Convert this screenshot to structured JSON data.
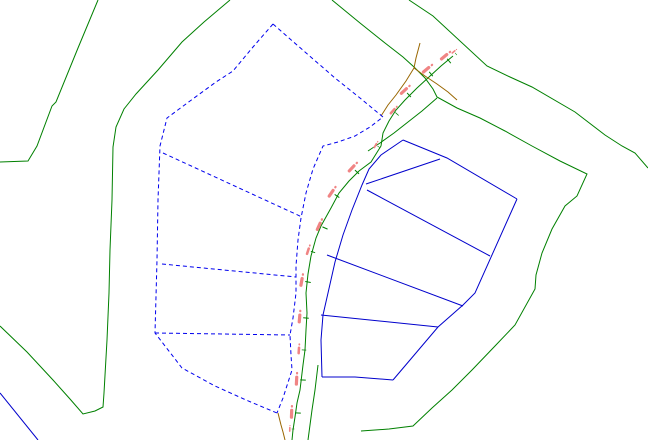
{
  "map": {
    "width": 648,
    "height": 440,
    "background": "#ffffff",
    "colors": {
      "boundary_green": "#008000",
      "alignment_brown": "#996600",
      "parcel_dashed_blue": "#0000ee",
      "parcel_solid_blue": "#0000cc",
      "station_label_red": "#f08484",
      "station_tick_green": "#008000"
    },
    "dash_pattern": "4,3",
    "layers": {
      "boundaries_green": [
        {
          "name": "outer-boundary-left-upper",
          "points": [
            [
              98,
              0
            ],
            [
              78,
              48
            ],
            [
              56,
              102
            ],
            [
              52,
              106
            ],
            [
              37,
              146
            ],
            [
              28,
              161
            ],
            [
              0,
              162
            ]
          ]
        },
        {
          "name": "outer-boundary-left-lower",
          "points": [
            [
              230,
              0
            ],
            [
              204,
              22
            ],
            [
              182,
              42
            ],
            [
              158,
              70
            ],
            [
              136,
              94
            ],
            [
              124,
              109
            ],
            [
              116,
              127
            ],
            [
              113,
              147
            ],
            [
              112,
              200
            ],
            [
              110,
              250
            ],
            [
              109,
              293
            ],
            [
              107,
              340
            ],
            [
              104,
              393
            ],
            [
              103,
              407
            ],
            [
              95,
              411
            ],
            [
              83,
              414
            ],
            [
              70,
              399
            ],
            [
              53,
              380
            ],
            [
              27,
              352
            ],
            [
              0,
              326
            ]
          ]
        },
        {
          "name": "outer-boundary-top-right",
          "points": [
            [
              409,
              0
            ],
            [
              433,
              16
            ],
            [
              487,
              66
            ],
            [
              510,
              77
            ],
            [
              532,
              87
            ],
            [
              575,
              112
            ],
            [
              605,
              135
            ],
            [
              622,
              146
            ],
            [
              635,
              153
            ],
            [
              648,
              168
            ]
          ]
        },
        {
          "name": "inner-boundary-right",
          "points": [
            [
              332,
              0
            ],
            [
              360,
              23
            ],
            [
              385,
              43
            ],
            [
              403,
              57
            ],
            [
              414,
              67
            ],
            [
              425,
              78
            ],
            [
              433,
              89
            ],
            [
              437,
              97
            ],
            [
              457,
              108
            ],
            [
              480,
              118
            ],
            [
              505,
              131
            ],
            [
              532,
              146
            ],
            [
              560,
              161
            ],
            [
              587,
              174
            ],
            [
              577,
              196
            ],
            [
              565,
              206
            ],
            [
              552,
              229
            ],
            [
              542,
              253
            ],
            [
              536,
              275
            ],
            [
              535,
              289
            ],
            [
              515,
              325
            ],
            [
              495,
              346
            ],
            [
              472,
              370
            ],
            [
              452,
              390
            ],
            [
              432,
              408
            ],
            [
              413,
              426
            ],
            [
              389,
              429
            ],
            [
              361,
              431
            ]
          ]
        },
        {
          "name": "road-right-edge-upper",
          "points": [
            [
              437,
              98
            ],
            [
              422,
              111
            ],
            [
              408,
              122
            ],
            [
              394,
              133
            ],
            [
              380,
              143
            ],
            [
              368,
              151
            ]
          ]
        },
        {
          "name": "road-right-edge-lower",
          "points": [
            [
              318,
              365
            ],
            [
              315,
              390
            ],
            [
              312,
              410
            ],
            [
              310,
              425
            ],
            [
              308,
              440
            ]
          ]
        },
        {
          "name": "road-centerline",
          "points": [
            [
              453,
              56
            ],
            [
              441,
              66
            ],
            [
              429,
              77
            ],
            [
              417,
              88
            ],
            [
              405,
              100
            ],
            [
              396,
              110
            ],
            [
              389,
              121
            ],
            [
              383,
              133
            ],
            [
              381,
              146
            ],
            [
              371,
              162
            ],
            [
              359,
              171
            ],
            [
              349,
              181
            ],
            [
              339,
              193
            ],
            [
              331,
              208
            ],
            [
              321,
              226
            ],
            [
              316,
              238
            ],
            [
              311,
              256
            ],
            [
              308,
              274
            ],
            [
              306,
              293
            ],
            [
              307,
              313
            ],
            [
              306,
              330
            ],
            [
              305,
              350
            ],
            [
              303,
              365
            ],
            [
              300,
              390
            ],
            [
              297,
              403
            ],
            [
              295,
              417
            ],
            [
              293,
              430
            ],
            [
              292,
              440
            ]
          ]
        }
      ],
      "alignment_brown": [
        {
          "name": "alignment-north",
          "points": [
            [
              420,
              43
            ],
            [
              416,
              58
            ],
            [
              414,
              68
            ],
            [
              406,
              81
            ],
            [
              396,
              95
            ],
            [
              388,
              105
            ],
            [
              381,
              116
            ]
          ]
        },
        {
          "name": "alignment-northeast-spur",
          "points": [
            [
              414,
              68
            ],
            [
              425,
              76
            ],
            [
              437,
              84
            ],
            [
              448,
              92
            ],
            [
              457,
              100
            ]
          ]
        },
        {
          "name": "alignment-south",
          "points": [
            [
              278,
              413
            ],
            [
              281,
              425
            ],
            [
              283,
              432
            ],
            [
              285,
              440
            ]
          ]
        }
      ],
      "parcels_dashed": [
        {
          "name": "dashed-fan-outline-left",
          "points": [
            [
              273,
              24
            ],
            [
              253,
              47
            ],
            [
              233,
              71
            ],
            [
              216,
              82
            ],
            [
              190,
              101
            ],
            [
              167,
              118
            ],
            [
              160,
              146
            ],
            [
              158,
              200
            ],
            [
              157,
              260
            ],
            [
              155,
              333
            ],
            [
              182,
              368
            ],
            [
              215,
              386
            ],
            [
              246,
              400
            ],
            [
              277,
              413
            ]
          ]
        },
        {
          "name": "dashed-fan-road-edge",
          "points": [
            [
              273,
              24
            ],
            [
              305,
              52
            ],
            [
              335,
              78
            ],
            [
              360,
              98
            ],
            [
              383,
              117
            ],
            [
              370,
              127
            ],
            [
              355,
              136
            ],
            [
              338,
              142
            ],
            [
              323,
              146
            ],
            [
              313,
              169
            ],
            [
              306,
              193
            ],
            [
              301,
              218
            ],
            [
              298,
              240
            ],
            [
              296,
              266
            ],
            [
              296,
              293
            ],
            [
              293,
              318
            ],
            [
              290,
              335
            ],
            [
              291,
              355
            ],
            [
              292,
              370
            ],
            [
              283,
              398
            ],
            [
              277,
              413
            ]
          ]
        },
        {
          "name": "dashed-lot-line-1",
          "points": [
            [
              163,
              153
            ],
            [
              302,
              217
            ]
          ]
        },
        {
          "name": "dashed-lot-line-2",
          "points": [
            [
              162,
              264
            ],
            [
              296,
              277
            ]
          ]
        },
        {
          "name": "dashed-lot-line-3",
          "points": [
            [
              155,
              333
            ],
            [
              290,
              335
            ]
          ]
        }
      ],
      "parcels_solid": [
        {
          "name": "solid-fan-road-edge",
          "points": [
            [
              403,
              140
            ],
            [
              381,
              155
            ],
            [
              369,
              169
            ],
            [
              362,
              185
            ],
            [
              352,
              210
            ],
            [
              343,
              235
            ],
            [
              335,
              262
            ],
            [
              328,
              293
            ],
            [
              323,
              315
            ],
            [
              321,
              340
            ],
            [
              322,
              377
            ]
          ]
        },
        {
          "name": "solid-fan-top-edge",
          "points": [
            [
              403,
              140
            ],
            [
              447,
              158
            ],
            [
              517,
              199
            ]
          ]
        },
        {
          "name": "solid-fan-right-edge",
          "points": [
            [
              517,
              199
            ],
            [
              475,
              293
            ],
            [
              463,
              305
            ],
            [
              438,
              327
            ],
            [
              393,
              380
            ]
          ]
        },
        {
          "name": "solid-fan-bottom-edge",
          "points": [
            [
              393,
              380
            ],
            [
              355,
              377
            ],
            [
              322,
              377
            ]
          ]
        },
        {
          "name": "solid-lot-line-1",
          "points": [
            [
              366,
              184
            ],
            [
              440,
              159
            ]
          ]
        },
        {
          "name": "solid-lot-line-2",
          "points": [
            [
              367,
              190
            ],
            [
              490,
              256
            ]
          ]
        },
        {
          "name": "solid-lot-line-3",
          "points": [
            [
              327,
              255
            ],
            [
              463,
              306
            ]
          ]
        },
        {
          "name": "solid-lot-line-4",
          "points": [
            [
              321,
              315
            ],
            [
              438,
              327
            ]
          ]
        },
        {
          "name": "solid-corner-southwest",
          "points": [
            [
              0,
              393
            ],
            [
              38,
              440
            ]
          ]
        }
      ],
      "station_marks": [
        {
          "x": 456,
          "y": 54,
          "angle": -40,
          "scale": 0.5
        },
        {
          "x": 449,
          "y": 61,
          "angle": -40,
          "scale": 1
        },
        {
          "x": 431,
          "y": 74,
          "angle": -40,
          "scale": 1
        },
        {
          "x": 409,
          "y": 95,
          "angle": -43,
          "scale": 1
        },
        {
          "x": 397,
          "y": 114,
          "angle": -48,
          "scale": 0.8
        },
        {
          "x": 379,
          "y": 147,
          "angle": -60,
          "scale": 0.6
        },
        {
          "x": 357,
          "y": 172,
          "angle": -47,
          "scale": 1
        },
        {
          "x": 337,
          "y": 196,
          "angle": -56,
          "scale": 1
        },
        {
          "x": 325,
          "y": 228,
          "angle": -66,
          "scale": 1
        },
        {
          "x": 313,
          "y": 252,
          "angle": -72,
          "scale": 0.8
        },
        {
          "x": 308,
          "y": 282,
          "angle": -80,
          "scale": 1
        },
        {
          "x": 306,
          "y": 318,
          "angle": -85,
          "scale": 1
        },
        {
          "x": 304,
          "y": 350,
          "angle": -86,
          "scale": 0.8
        },
        {
          "x": 303,
          "y": 380,
          "angle": -87,
          "scale": 1
        },
        {
          "x": 298,
          "y": 413,
          "angle": -88,
          "scale": 1
        },
        {
          "x": 293,
          "y": 429,
          "angle": -88,
          "scale": 0.5
        }
      ]
    }
  }
}
